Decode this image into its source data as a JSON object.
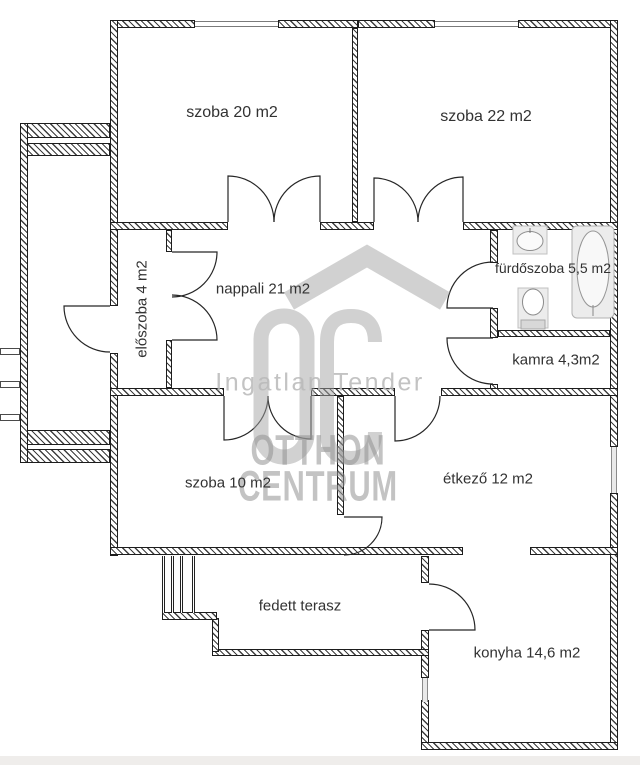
{
  "plan": {
    "rooms": [
      {
        "id": "szoba20",
        "label": "szoba 20 m2"
      },
      {
        "id": "szoba22",
        "label": "szoba 22 m2"
      },
      {
        "id": "eloszoba",
        "label": "előszoba 4 m2"
      },
      {
        "id": "nappali",
        "label": "nappali 21 m2"
      },
      {
        "id": "furdoszoba",
        "label": "fürdőszoba 5,5 m2"
      },
      {
        "id": "kamra",
        "label": "kamra 4,3m2"
      },
      {
        "id": "szoba10",
        "label": "szoba 10 m2"
      },
      {
        "id": "etkezo",
        "label": "étkező 12 m2"
      },
      {
        "id": "terasz",
        "label": "fedett terasz"
      },
      {
        "id": "konyha",
        "label": "konyha 14,6 m2"
      }
    ]
  },
  "watermark": {
    "logo": "OC",
    "tagline": "Ingatlan Tender",
    "brand_line1": "OTTHON",
    "brand_line2": "CENTRUM",
    "color": "#a6a6a6"
  },
  "colors": {
    "wall": "#1d1d1d",
    "label": "#323232",
    "background": "#ffffff"
  }
}
